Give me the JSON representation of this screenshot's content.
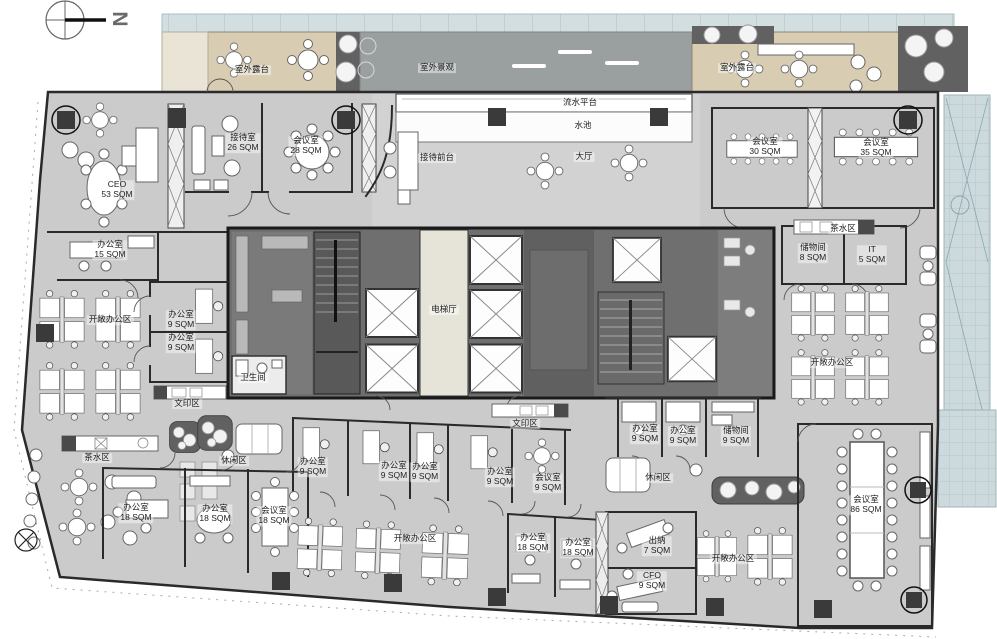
{
  "title": "办公楼层平面图",
  "compass": {
    "letter": "N"
  },
  "colors": {
    "c-floor": "#cbcbcb",
    "c-wall": "#2a2a2a",
    "c-core": "#6f6f6f",
    "c-coreDark": "#595959",
    "c-hall": "#e6e4d9",
    "c-terrace": "#d8cdb2",
    "c-landscape": "#9aa0a0",
    "c-planter": "#616161",
    "c-glass": "#ccdade"
  },
  "labels": [
    {
      "id": "terrace-left",
      "name": "室外露台",
      "area": "",
      "x": 252,
      "y": 70
    },
    {
      "id": "landscape",
      "name": "室外景观",
      "area": "",
      "x": 437,
      "y": 68
    },
    {
      "id": "terrace-right",
      "name": "室外露台",
      "area": "",
      "x": 737,
      "y": 68
    },
    {
      "id": "water-platform",
      "name": "流水平台",
      "area": "",
      "x": 580,
      "y": 103
    },
    {
      "id": "pool",
      "name": "水池",
      "area": "",
      "x": 583,
      "y": 126
    },
    {
      "id": "reception-counter",
      "name": "接待前台",
      "area": "",
      "x": 437,
      "y": 158
    },
    {
      "id": "lobby",
      "name": "大厅",
      "area": "",
      "x": 584,
      "y": 157
    },
    {
      "id": "reception-room",
      "name": "接待室",
      "area": "26 SQM",
      "x": 243,
      "y": 143
    },
    {
      "id": "meeting-28",
      "name": "会议室",
      "area": "28 SQM",
      "x": 306,
      "y": 146
    },
    {
      "id": "ceo-office",
      "name": "CEO",
      "area": "53 SQM",
      "x": 117,
      "y": 190
    },
    {
      "id": "meeting-30",
      "name": "会议室",
      "area": "30 SQM",
      "x": 765,
      "y": 147
    },
    {
      "id": "meeting-35",
      "name": "会议室",
      "area": "35 SQM",
      "x": 876,
      "y": 148
    },
    {
      "id": "office-15",
      "name": "办公室",
      "area": "15 SQM",
      "x": 110,
      "y": 250
    },
    {
      "id": "open-office-left",
      "name": "开敞办公区",
      "area": "",
      "x": 110,
      "y": 320
    },
    {
      "id": "office-9-a",
      "name": "办公室",
      "area": "9 SQM",
      "x": 181,
      "y": 320
    },
    {
      "id": "office-9-b",
      "name": "办公室",
      "area": "9 SQM",
      "x": 181,
      "y": 343
    },
    {
      "id": "restroom",
      "name": "卫生间",
      "area": "",
      "x": 253,
      "y": 378
    },
    {
      "id": "print-left",
      "name": "文印区",
      "area": "",
      "x": 187,
      "y": 404
    },
    {
      "id": "elevator-hall",
      "name": "电梯厅",
      "area": "",
      "x": 444,
      "y": 310
    },
    {
      "id": "storage-8",
      "name": "储物间",
      "area": "8 SQM",
      "x": 813,
      "y": 253
    },
    {
      "id": "it-room",
      "name": "IT",
      "area": "5 SQM",
      "x": 872,
      "y": 255
    },
    {
      "id": "tea-right",
      "name": "茶水区",
      "area": "",
      "x": 843,
      "y": 229
    },
    {
      "id": "open-office-right",
      "name": "开敞办公区",
      "area": "",
      "x": 832,
      "y": 363
    },
    {
      "id": "tea-left",
      "name": "茶水区",
      "area": "",
      "x": 97,
      "y": 458
    },
    {
      "id": "lounge-left",
      "name": "休闲区",
      "area": "",
      "x": 234,
      "y": 461
    },
    {
      "id": "print-center",
      "name": "文印区",
      "area": "",
      "x": 525,
      "y": 424
    },
    {
      "id": "office-9-c",
      "name": "办公室",
      "area": "9 SQM",
      "x": 313,
      "y": 467
    },
    {
      "id": "office-9-d",
      "name": "办公室",
      "area": "9 SQM",
      "x": 394,
      "y": 471
    },
    {
      "id": "office-9-e",
      "name": "办公室",
      "area": "9 SQM",
      "x": 425,
      "y": 472
    },
    {
      "id": "office-9-f",
      "name": "办公室",
      "area": "9 SQM",
      "x": 500,
      "y": 477
    },
    {
      "id": "meeting-9",
      "name": "会议室",
      "area": "9 SQM",
      "x": 548,
      "y": 483
    },
    {
      "id": "office-9-g",
      "name": "办公室",
      "area": "9 SQM",
      "x": 645,
      "y": 434
    },
    {
      "id": "office-9-h",
      "name": "办公室",
      "area": "9 SQM",
      "x": 683,
      "y": 436
    },
    {
      "id": "storage-9",
      "name": "储物间",
      "area": "9 SQM",
      "x": 736,
      "y": 436
    },
    {
      "id": "lounge-center",
      "name": "休闲区",
      "area": "",
      "x": 658,
      "y": 478
    },
    {
      "id": "office-18-a",
      "name": "办公室",
      "area": "18 SQM",
      "x": 136,
      "y": 513
    },
    {
      "id": "office-18-b",
      "name": "办公室",
      "area": "18 SQM",
      "x": 215,
      "y": 514
    },
    {
      "id": "meeting-18",
      "name": "会议室",
      "area": "18 SQM",
      "x": 274,
      "y": 516
    },
    {
      "id": "open-office-bottom",
      "name": "开敞办公区",
      "area": "",
      "x": 415,
      "y": 539
    },
    {
      "id": "office-18-c",
      "name": "办公室",
      "area": "18 SQM",
      "x": 533,
      "y": 543
    },
    {
      "id": "office-18-d",
      "name": "办公室",
      "area": "18 SQM",
      "x": 578,
      "y": 548
    },
    {
      "id": "cashier",
      "name": "出纳",
      "area": "7 SQM",
      "x": 657,
      "y": 546
    },
    {
      "id": "cfo-office",
      "name": "CFO",
      "area": "9 SQM",
      "x": 652,
      "y": 581
    },
    {
      "id": "open-office-br",
      "name": "开敞办公区",
      "area": "",
      "x": 733,
      "y": 559
    },
    {
      "id": "meeting-86",
      "name": "会议室",
      "area": "86 SQM",
      "x": 866,
      "y": 505
    }
  ]
}
